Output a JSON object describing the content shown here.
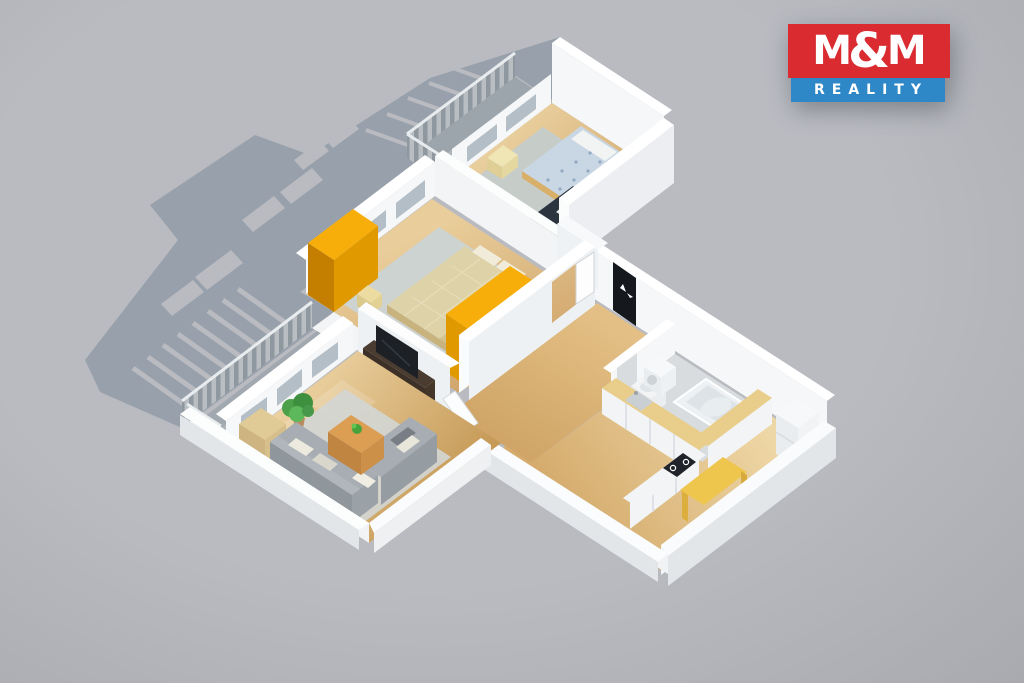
{
  "logo": {
    "m1": "M",
    "amp": "&",
    "m2": "M",
    "reality": "REALITY"
  },
  "scene": {
    "type": "isometric-3d-floor-plan-render",
    "subject": "two-bedroom apartment: living room, master bedroom, small bedroom, kitchen, bathroom, hallway, two balconies",
    "rooms": [
      {
        "name": "living-room",
        "furniture": [
          "corner-sofa",
          "sofa-pillows",
          "coffee-table",
          "table-plant",
          "area-rug",
          "tv-stand",
          "tv",
          "sideboard",
          "potted-plant",
          "open-door",
          "windows",
          "balcony-access"
        ]
      },
      {
        "name": "master-bedroom",
        "furniture": [
          "double-bed",
          "pillows",
          "area-rug",
          "yellow-wardrobe-left",
          "yellow-wardrobe-right-with-white-drawers",
          "nightstands",
          "windows",
          "open-door"
        ]
      },
      {
        "name": "small-bedroom",
        "furniture": [
          "single-bed",
          "pillow",
          "yellow-nightstand",
          "desk",
          "monitor",
          "desk-chair",
          "white-bench",
          "area-rug",
          "windows"
        ]
      },
      {
        "name": "kitchen",
        "furniture": [
          "l-shaped-counter",
          "sink",
          "cooktop",
          "tall-cabinet-fridge",
          "dining-table"
        ]
      },
      {
        "name": "bathroom",
        "furniture": [
          "corner-bathtub",
          "washbasin",
          "washing-machine",
          "partition-wall"
        ]
      },
      {
        "name": "hallway",
        "furniture": [
          "black-entrance-door"
        ]
      },
      {
        "name": "balcony-left",
        "furniture": [
          "slatted-railing"
        ]
      },
      {
        "name": "balcony-top",
        "furniture": [
          "slatted-railing"
        ]
      }
    ]
  },
  "palette": {
    "bg": "#b9bbc1",
    "bg_edge": "#a8aab0",
    "shadow": "#98a1ab",
    "wall": "#f5f7f8",
    "wall_top": "#ffffff",
    "wall_shade": "#e3e6e9",
    "glass": "#b4bec6",
    "wood_light": "#ecd2a2",
    "wood_dark": "#c79b60",
    "yellow": "#f7ae0a",
    "yellow_dark": "#e09a00",
    "yellow_deep": "#c47f00",
    "yellow_pale": "#ecdca2",
    "counter_top": "#e9cd8a",
    "sofa": "#a7adb2",
    "sofa_dark": "#8f969c",
    "table_wood": "#dc9e52",
    "tv_dark": "#20242a",
    "door_black": "#15181d",
    "bath_floor": "#d8dcde",
    "duvet_master": "#ddd2a8",
    "duvet_single": "#c9d7e4",
    "white_furn": "#f2f4f5",
    "rug_living": "#d3d6d2",
    "rug_master": "#cdd3d0",
    "rug_small": "#c6cdc9",
    "plant": "#3e8f3e",
    "logo_red": "#d92b30",
    "logo_blue": "#2e87c6"
  }
}
